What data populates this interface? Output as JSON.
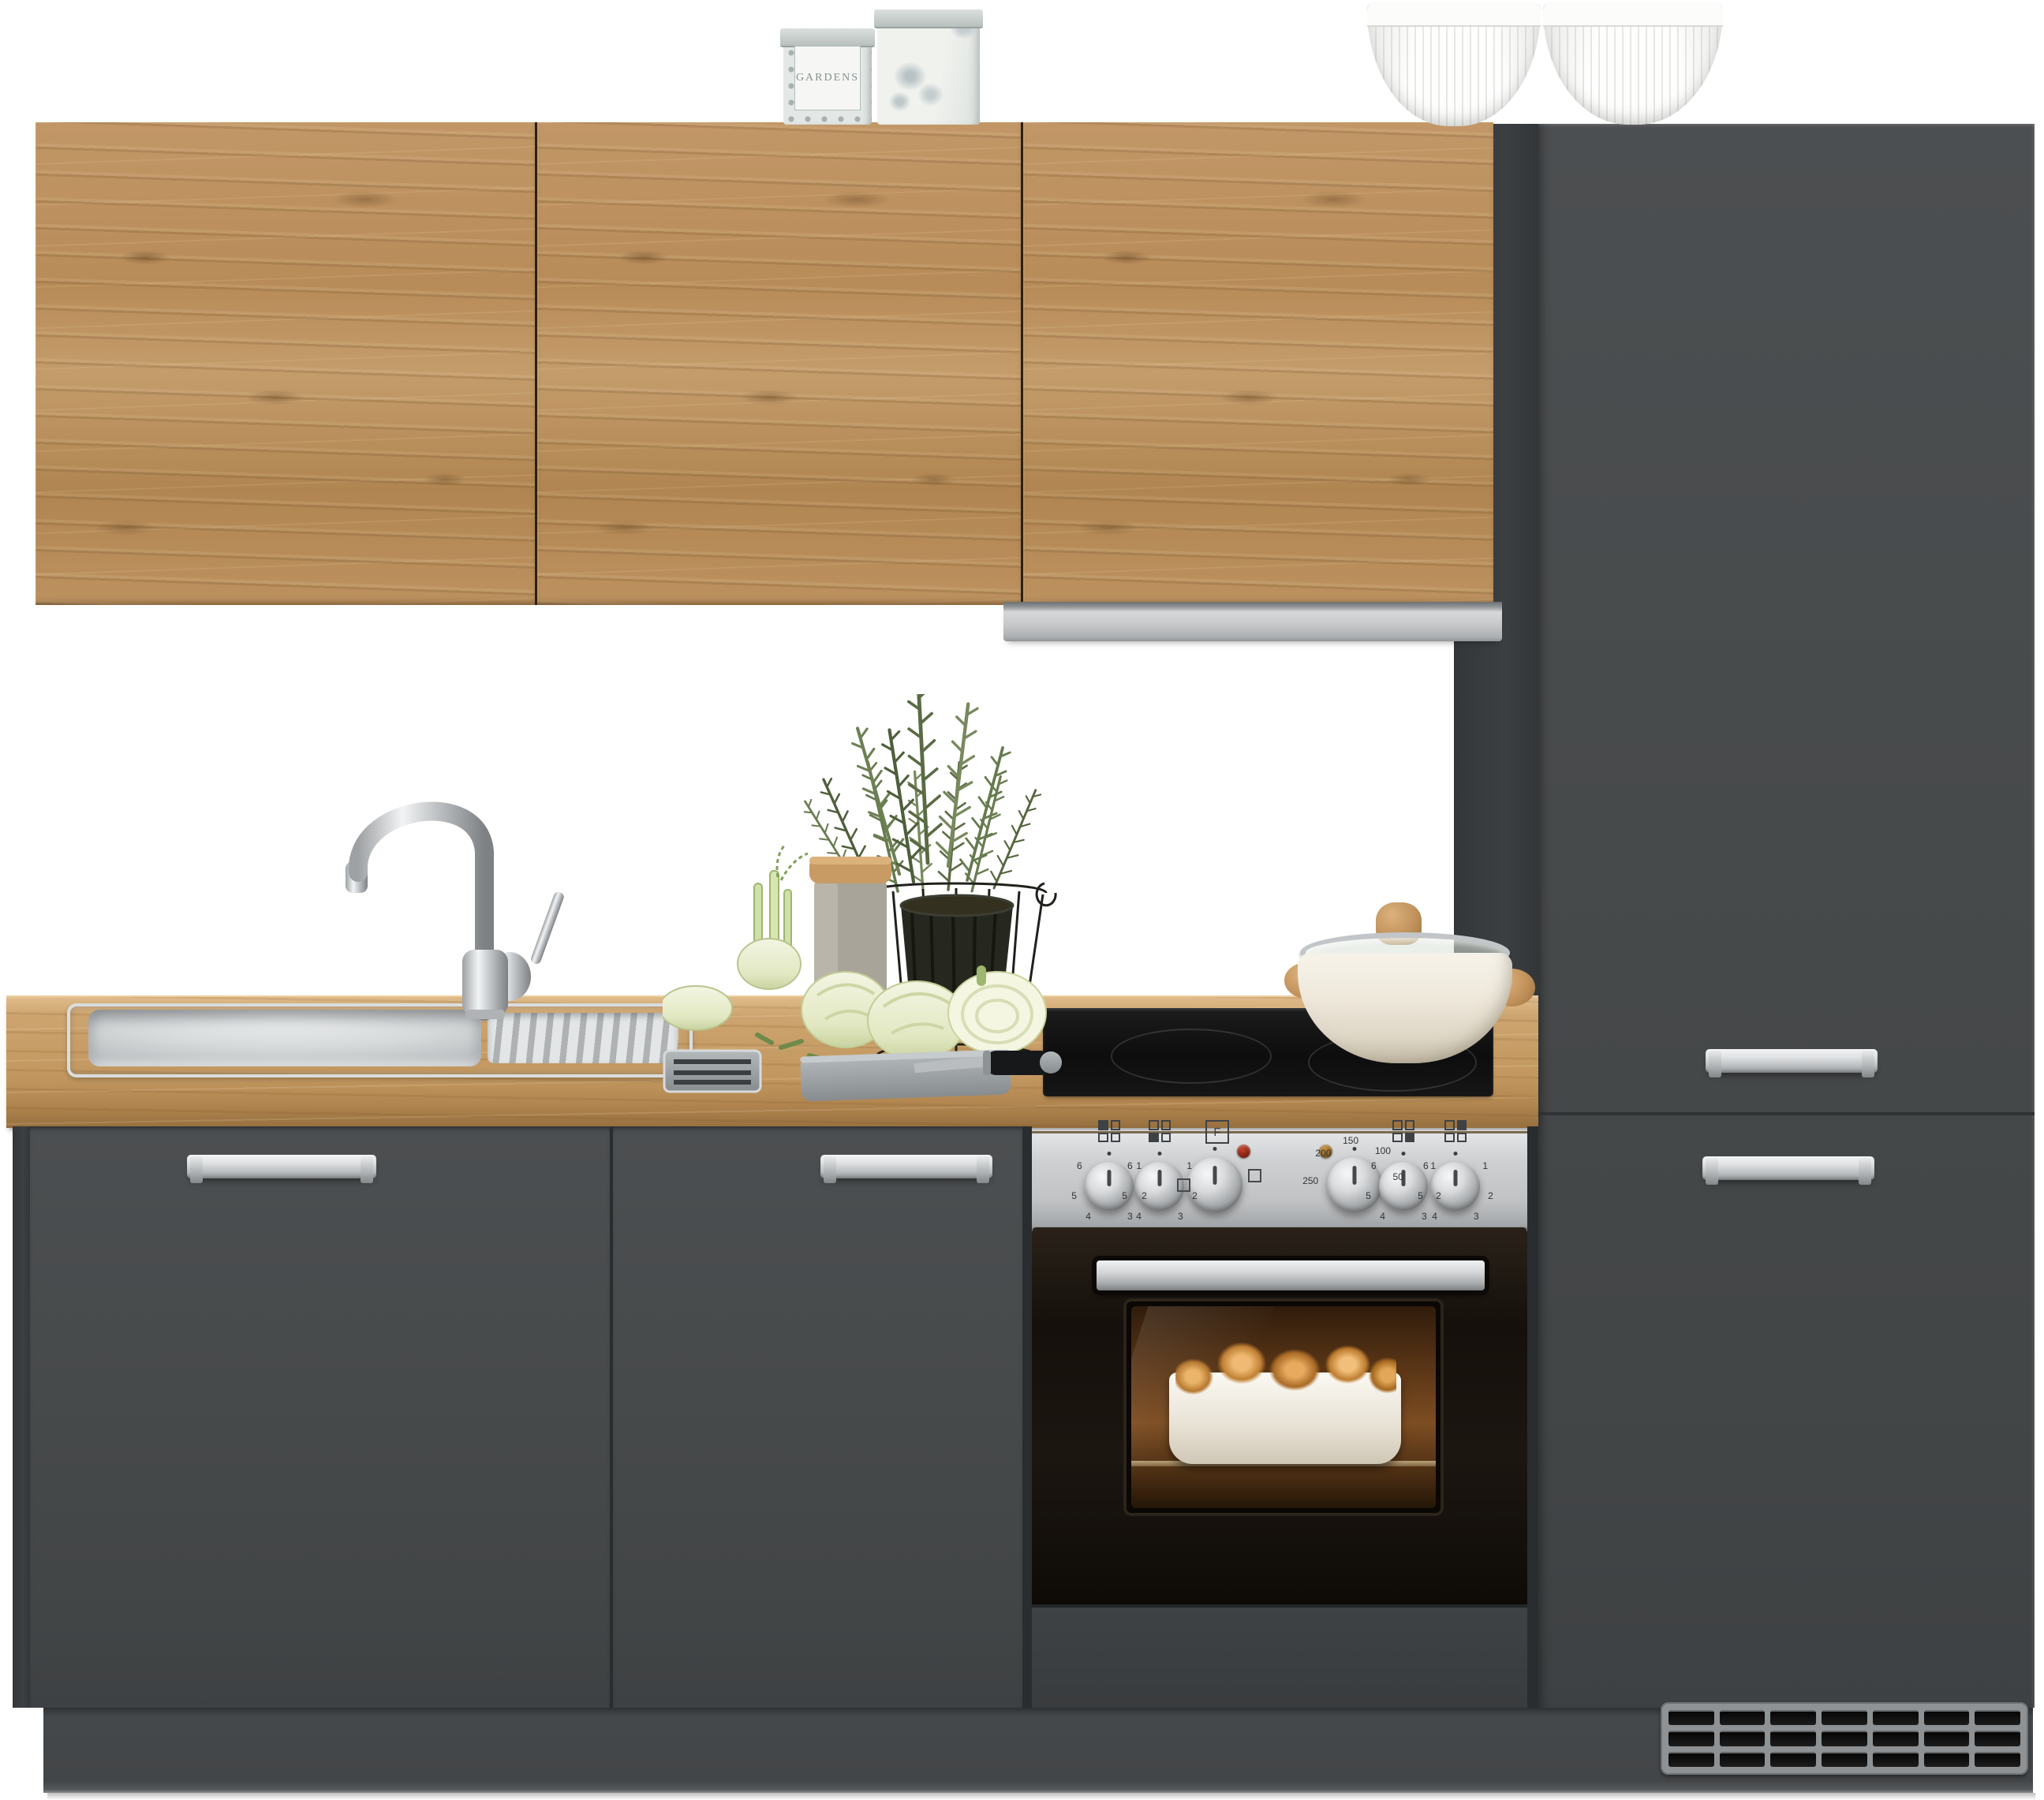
{
  "meta": {
    "type": "product-photo",
    "subject": "Kitchen unit with oak wall cabinets, anthracite grey base and tall cabinets, stainless sink, ceramic hob and built-in oven",
    "background": "#ffffff"
  },
  "palette": {
    "background": "#ffffff",
    "oak_wood": "#bb9161",
    "oak_wood_dark": "#7e5a33",
    "oak_wood_light": "#d2ab77",
    "counter_wood": "#c79c67",
    "cabinet_front_grey": "#474a4b",
    "cabinet_side_grey": "#393c3e",
    "plinth_grey": "#45484a",
    "stainless": "#c9cbcd",
    "handle_silver": "#e2e4e5",
    "oven_black": "#19140f",
    "oven_glow_amber": "#b97a3a",
    "hob_black": "#121212",
    "pot_cream": "#f0ebdf",
    "greens": "#65784c",
    "fennel_pale": "#edf0d8",
    "grille_frame": "#8f9294",
    "grille_slot": "#111111",
    "indicator_red": "#8a2212",
    "indicator_amber": "#96661c"
  },
  "wall_cabinets": {
    "door_count": 3
  },
  "range_hood": {
    "finish": "stainless steel"
  },
  "decor": {
    "tin_small": {
      "label": "GARDENS"
    },
    "tin_large": {
      "pattern": "grey roses"
    },
    "bowls": {
      "count": 2,
      "color": "#ffffff"
    }
  },
  "sink_area": {
    "basins": 1,
    "drainer": true,
    "faucet": "chrome high-arc mixer"
  },
  "props": {
    "items": [
      "rosemary plant in wire basket",
      "storage jar with wooden lid",
      "fennel bulbs",
      "stone cutting board",
      "kitchen knife",
      "metal tray"
    ]
  },
  "cooktop": {
    "type": "ceramic hob",
    "pot": "cream casserole with glass lid"
  },
  "oven": {
    "knob_count": 6,
    "knob_icons": [
      "tl",
      "bl",
      "fn",
      "temp",
      "br",
      "tr"
    ],
    "function_symbol": "F",
    "temp_scale": [
      "250",
      "200",
      "150",
      "100",
      "50"
    ],
    "burner_scale": [
      "1",
      "2",
      "3",
      "4",
      "5",
      "6"
    ],
    "indicator_lights": [
      "red",
      "amber"
    ]
  },
  "base_cabinets": {
    "door_count": 2,
    "handle_count": 2
  },
  "tall_unit": {
    "door_count": 2,
    "handle_count": 2,
    "vent_grille": {
      "rows": 3,
      "columns": 7
    }
  }
}
